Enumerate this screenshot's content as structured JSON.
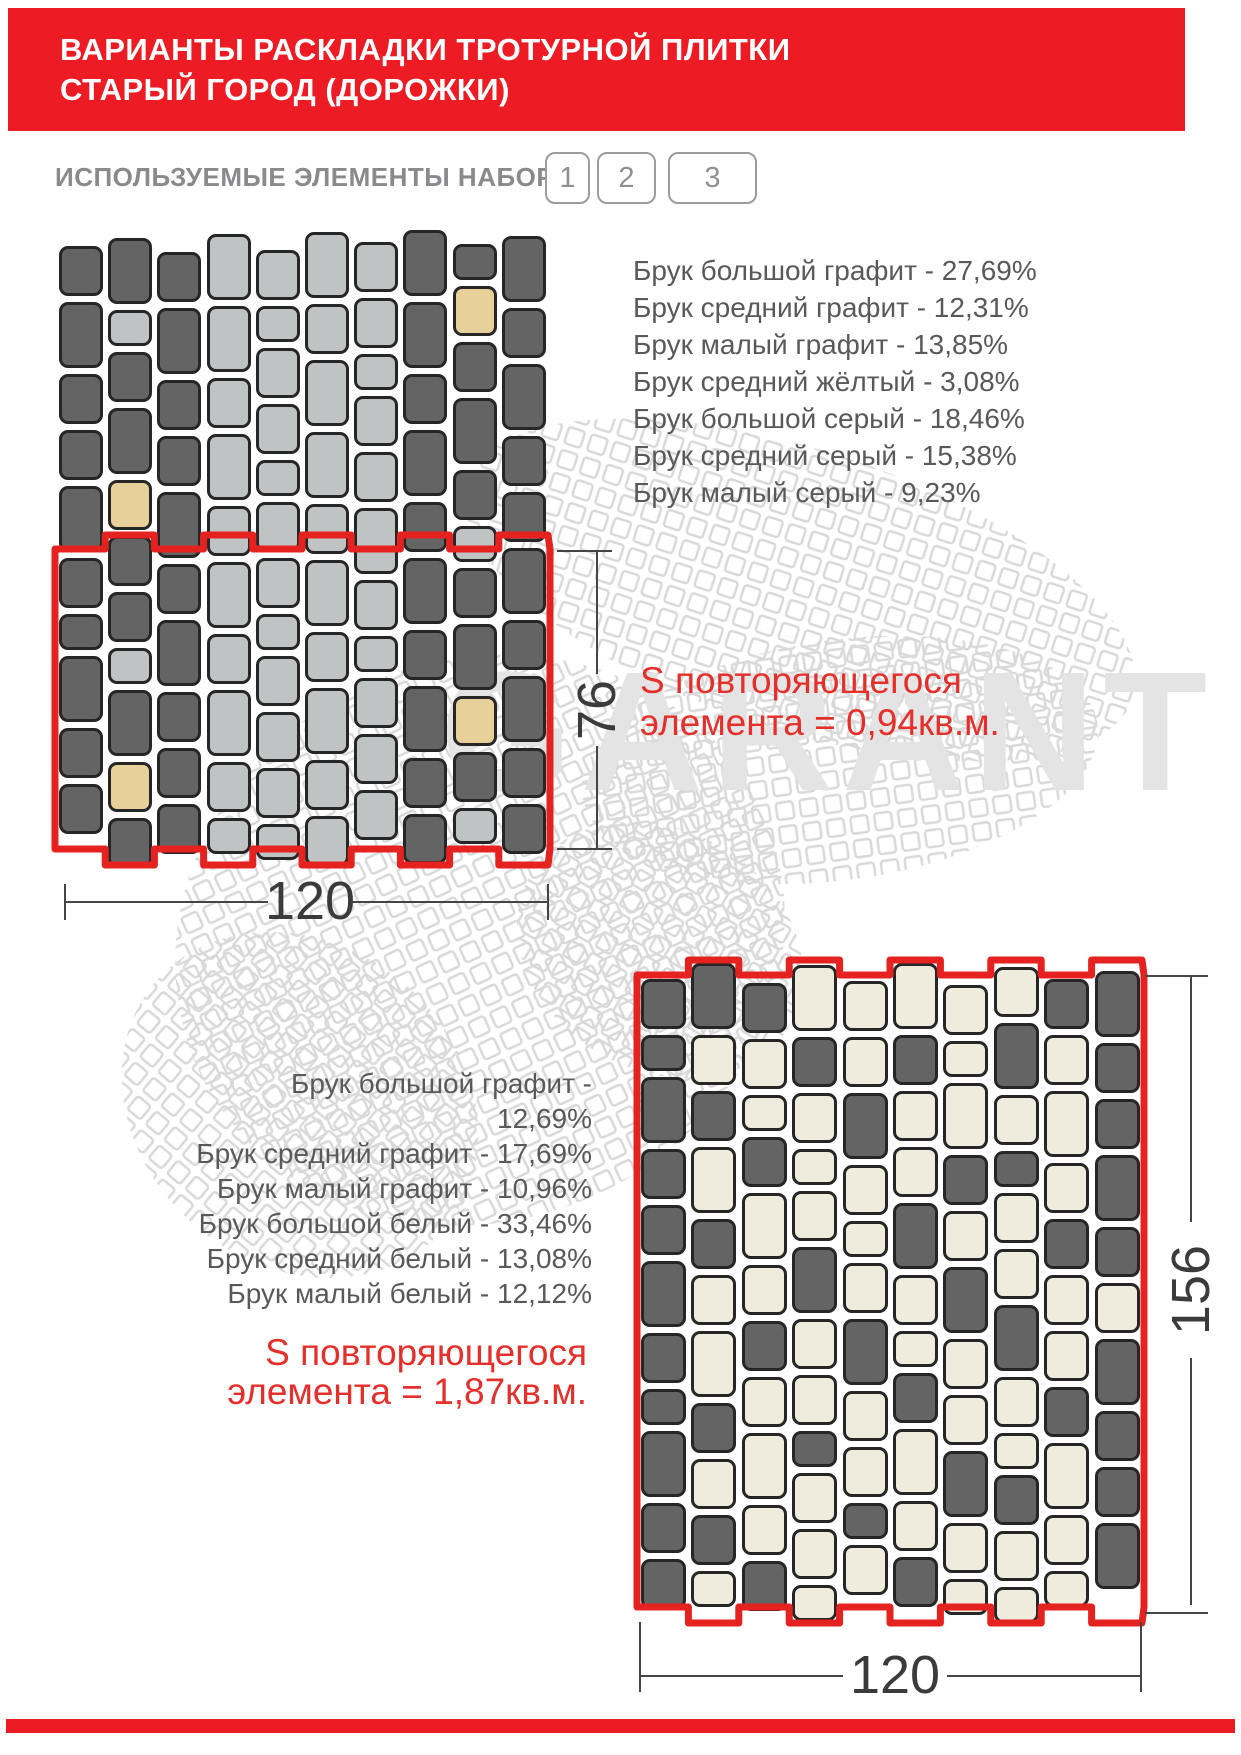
{
  "header": {
    "title_line1": "ВАРИАНТЫ РАСКЛАДКИ ТРОТУРНОЙ ПЛИТКИ",
    "title_line2": "СТАРЫЙ ГОРОД (ДОРОЖКИ)",
    "accent_color": "#ED1C24"
  },
  "elements_row": {
    "label": "ИСПОЛЬЗУЕМЫЕ ЭЛЕМЕНТЫ НАБОРА",
    "buttons": [
      "1",
      "2",
      "3"
    ]
  },
  "watermark": {
    "text": "GARANT",
    "color": "#e4e4e4",
    "mesh_color": "#d9d9d9"
  },
  "layout1": {
    "items": [
      "Брук большой графит - 27,69%",
      "Брук средний графит - 12,31%",
      "Брук малый графит - 13,85%",
      "Брук средний жёлтый - 3,08%",
      "Брук большой серый - 18,46%",
      "Брук средний серый - 15,38%",
      "Брук малый серый - 9,23%"
    ],
    "area_line1": "S повторяющегося",
    "area_line2": "элемента = 0,94кв.м.",
    "dim_width": "120",
    "dim_height": "76"
  },
  "layout2": {
    "items": [
      "Брук большой графит - 12,69%",
      "Брук средний графит - 17,69%",
      "Брук малый графит - 10,96%",
      "Брук большой белый - 33,46%",
      "Брук средний белый - 13,08%",
      "Брук малый белый - 12,12%"
    ],
    "area_line1": "S повторяющегося",
    "area_line2": "элемента = 1,87кв.м.",
    "dim_width": "120",
    "dim_height": "156"
  },
  "palette": {
    "d": "#646464",
    "l": "#c0c3c3",
    "y": "#e8d09b",
    "w": "#efecdd",
    "red": "#e42320"
  },
  "patterns": [
    {
      "name": "pattern-graphite-grey",
      "x": 59,
      "y": 240,
      "pitch": 49.2,
      "tile_w": 44,
      "gap": 6,
      "sizes": {
        "S": 36,
        "M": 50,
        "L": 66
      },
      "columns": [
        {
          "dy": 6,
          "tiles": [
            "M:d",
            "L:d",
            "M:d",
            "M:d",
            "L:d",
            "M:d",
            "S:d",
            "L:d",
            "M:d",
            "M:d"
          ]
        },
        {
          "dy": -2,
          "tiles": [
            "L:d",
            "S:l",
            "M:d",
            "L:d",
            "M:y",
            "M:d",
            "M:d",
            "S:l",
            "L:d",
            "M:y",
            "M:d"
          ]
        },
        {
          "dy": 12,
          "tiles": [
            "M:d",
            "L:d",
            "M:d",
            "M:d",
            "L:d",
            "M:d",
            "L:d",
            "M:d",
            "M:d",
            "M:d"
          ]
        },
        {
          "dy": -6,
          "tiles": [
            "L:l",
            "L:l",
            "M:l",
            "L:l",
            "M:l",
            "L:l",
            "M:l",
            "L:l",
            "M:l",
            "S:l"
          ]
        },
        {
          "dy": 10,
          "tiles": [
            "M:l",
            "S:l",
            "M:l",
            "M:l",
            "S:l",
            "M:l",
            "M:l",
            "S:l",
            "M:l",
            "M:l",
            "M:l",
            "S:l"
          ]
        },
        {
          "dy": -8,
          "tiles": [
            "L:l",
            "M:l",
            "L:l",
            "L:l",
            "M:l",
            "L:l",
            "M:l",
            "L:l",
            "M:l",
            "M:l"
          ]
        },
        {
          "dy": 2,
          "tiles": [
            "M:l",
            "M:l",
            "S:l",
            "M:l",
            "M:l",
            "L:l",
            "M:l",
            "S:l",
            "M:l",
            "M:l",
            "M:l"
          ]
        },
        {
          "dy": -10,
          "tiles": [
            "L:d",
            "L:d",
            "M:d",
            "L:d",
            "M:d",
            "L:d",
            "M:d",
            "L:d",
            "M:d",
            "M:d"
          ]
        },
        {
          "dy": 4,
          "tiles": [
            "S:d",
            "M:y",
            "M:d",
            "L:d",
            "M:d",
            "S:l",
            "M:d",
            "L:d",
            "M:y",
            "M:d",
            "S:l"
          ]
        },
        {
          "dy": -4,
          "tiles": [
            "L:d",
            "M:d",
            "L:d",
            "M:d",
            "M:d",
            "L:d",
            "M:d",
            "L:d",
            "M:d",
            "M:d"
          ]
        }
      ],
      "outline": {
        "x0": 55,
        "x1": 550,
        "top": 549,
        "top_notch": 535,
        "bottom": 849,
        "bottom_notch": 865
      }
    },
    {
      "name": "pattern-graphite-white",
      "x": 641,
      "y": 977,
      "pitch": 50.4,
      "tile_w": 45,
      "gap": 6,
      "sizes": {
        "S": 36,
        "M": 50,
        "L": 66
      },
      "columns": [
        {
          "dy": 2,
          "tiles": [
            "M:d",
            "S:d",
            "L:d",
            "M:d",
            "M:d",
            "L:d",
            "M:d",
            "S:d",
            "L:d",
            "M:d",
            "M:d"
          ]
        },
        {
          "dy": -14,
          "tiles": [
            "L:d",
            "M:w",
            "M:d",
            "L:w",
            "M:d",
            "M:w",
            "L:w",
            "M:d",
            "M:w",
            "M:d",
            "S:w"
          ]
        },
        {
          "dy": 6,
          "tiles": [
            "M:d",
            "M:w",
            "S:w",
            "M:d",
            "L:w",
            "M:w",
            "M:d",
            "M:w",
            "L:w",
            "M:w",
            "M:d"
          ]
        },
        {
          "dy": -12,
          "tiles": [
            "L:w",
            "M:d",
            "M:w",
            "S:w",
            "M:w",
            "L:d",
            "M:w",
            "M:w",
            "S:d",
            "M:w",
            "M:w",
            "S:w"
          ]
        },
        {
          "dy": 4,
          "tiles": [
            "M:w",
            "M:w",
            "L:d",
            "M:w",
            "S:w",
            "M:w",
            "L:d",
            "M:w",
            "M:w",
            "S:d",
            "M:w"
          ]
        },
        {
          "dy": -14,
          "tiles": [
            "L:w",
            "M:d",
            "M:w",
            "M:w",
            "L:d",
            "M:w",
            "S:w",
            "M:d",
            "L:w",
            "M:w",
            "M:d"
          ]
        },
        {
          "dy": 8,
          "tiles": [
            "M:w",
            "S:w",
            "L:w",
            "M:d",
            "M:w",
            "L:d",
            "M:w",
            "M:w",
            "L:d",
            "M:w",
            "S:w"
          ]
        },
        {
          "dy": -10,
          "tiles": [
            "M:w",
            "L:d",
            "M:w",
            "S:d",
            "M:w",
            "M:w",
            "L:d",
            "M:w",
            "S:w",
            "M:d",
            "M:w",
            "S:w"
          ]
        },
        {
          "dy": 2,
          "tiles": [
            "M:d",
            "M:w",
            "L:w",
            "M:w",
            "M:d",
            "M:w",
            "M:w",
            "M:d",
            "L:w",
            "M:w",
            "S:w"
          ]
        },
        {
          "dy": -6,
          "tiles": [
            "L:d",
            "M:d",
            "M:d",
            "L:d",
            "M:d",
            "M:w",
            "L:d",
            "M:d",
            "M:d",
            "L:d"
          ]
        }
      ],
      "outline": {
        "x0": 637,
        "x1": 1144,
        "top": 975,
        "top_notch": 960,
        "bottom": 1607,
        "bottom_notch": 1623
      }
    }
  ]
}
